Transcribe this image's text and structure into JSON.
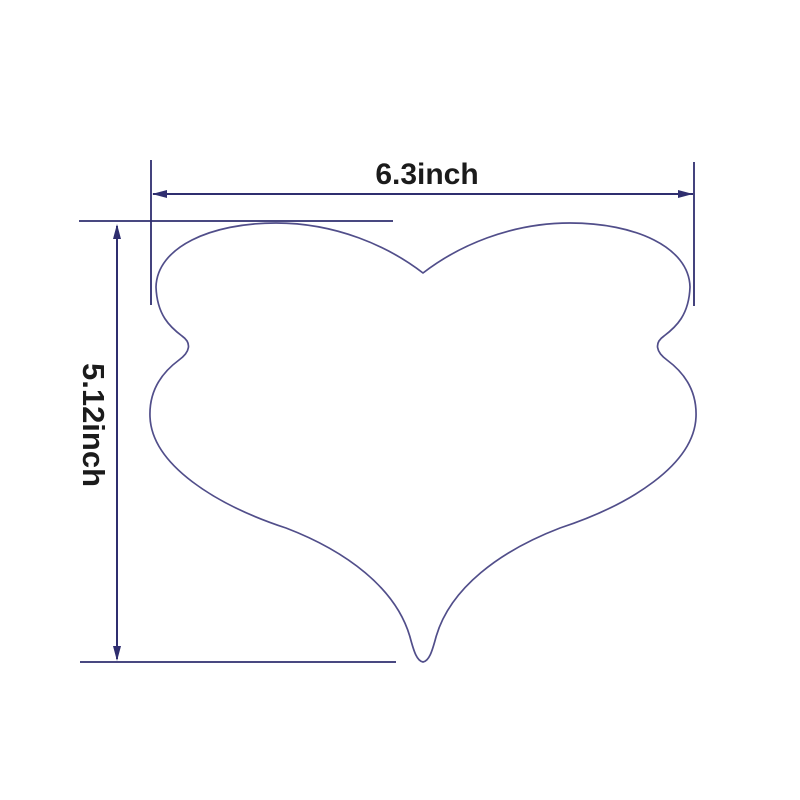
{
  "page": {
    "background": "#ffffff",
    "description": "Dimension diagram of a heart/butterfly shaped tool outline with width and height measurements"
  },
  "colors": {
    "outline": "#514e8a",
    "dimension_lines": "#2f2e6f",
    "label_text": "#1b1b1b"
  },
  "labels": {
    "width": "6.3inch",
    "height": "5.12inch"
  },
  "shape": {
    "name": "heart-butterfly-outline",
    "path": "M 423 273 C 458 246, 510 223, 570 223 C 635 223, 689 247, 690 287 C 689 315, 676 327, 664 336 C 654 343, 656 352, 667 360 C 686 374, 697 393, 696 417 C 694 465, 630 505, 560 528 C 500 551, 450 588, 436 637 C 432 652, 429 661, 423 662 C 417 661, 414 652, 410 637 C 396 588, 346 551, 286 528 C 216 505, 152 465, 150 417 C 149 393, 160 374, 179 360 C 190 352, 192 343, 182 336 C 170 327, 157 315, 156 287 C 157 247, 211 223, 276 223 C 336 223, 388 246, 423 273 Z"
  },
  "dimension_geometry": {
    "width_line": {
      "x1": 153,
      "y": 194,
      "x2": 693
    },
    "height_line": {
      "x": 117,
      "y1": 225,
      "y2": 660
    },
    "extension_left_x": 151,
    "extension_right_x": 694,
    "extension_top_y": 221,
    "extension_bottom_y": 662
  }
}
